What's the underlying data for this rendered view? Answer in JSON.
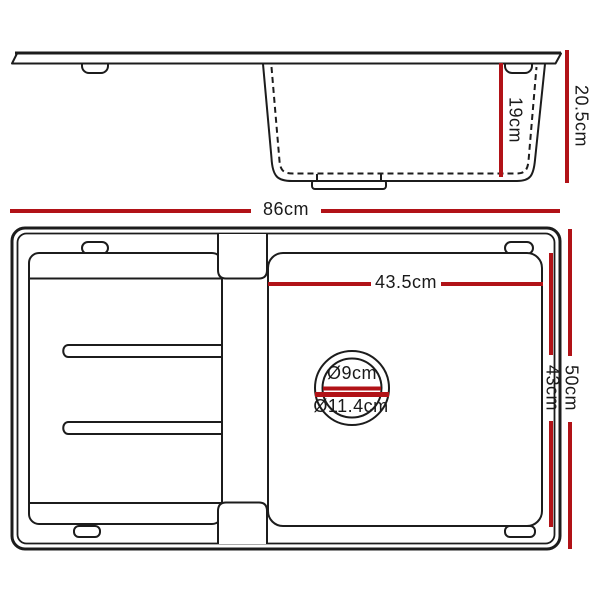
{
  "colors": {
    "dimension_color": "#b11217",
    "outline_color": "#1c1c1c"
  },
  "side_view": {
    "bowl_depth": "19cm",
    "overall_depth": "20.5cm"
  },
  "top_view": {
    "overall_width": "86cm",
    "bowl_width": "43.5cm",
    "bowl_length": "43cm",
    "overall_length": "50cm",
    "drain": {
      "inner_diameter": "Ø9cm",
      "outer_diameter": "Ø11.4cm"
    }
  }
}
